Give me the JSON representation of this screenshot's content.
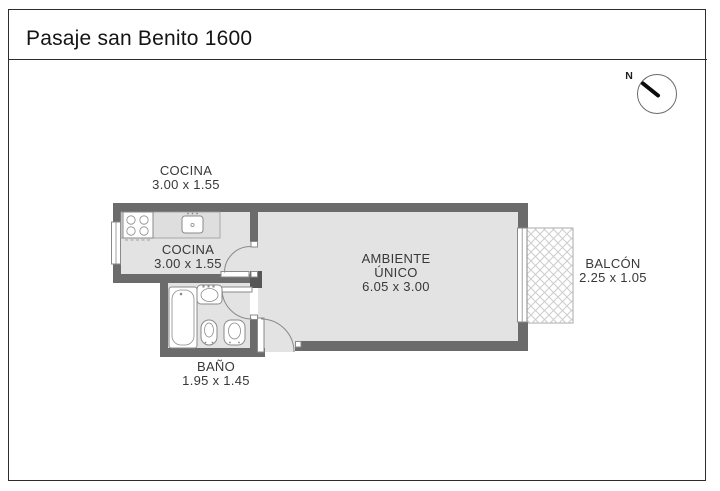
{
  "header": {
    "title": "Pasaje san Benito 1600"
  },
  "compass": {
    "label": "N"
  },
  "labels": {
    "cocina_outside": {
      "name": "COCINA",
      "dims": "3.00 x 1.55"
    },
    "cocina_inside": {
      "name": "COCINA",
      "dims": "3.00 x 1.55"
    },
    "ambiente": {
      "line1": "AMBIENTE",
      "line2": "ÚNICO",
      "dims": "6.05 x 3.00"
    },
    "bano": {
      "name": "BAÑO",
      "dims": "1.95 x 1.45"
    },
    "balcon": {
      "name": "BALCÓN",
      "dims": "2.25 x 1.05"
    }
  },
  "colors": {
    "wall": "#6b6b6b",
    "wallDark": "#565656",
    "floor": "#e3e3e3",
    "counter": "#dedede",
    "outline": "#8a8a8a",
    "hatch": "#cccccc",
    "text": "#383838",
    "frame": "#2d2d2d"
  }
}
